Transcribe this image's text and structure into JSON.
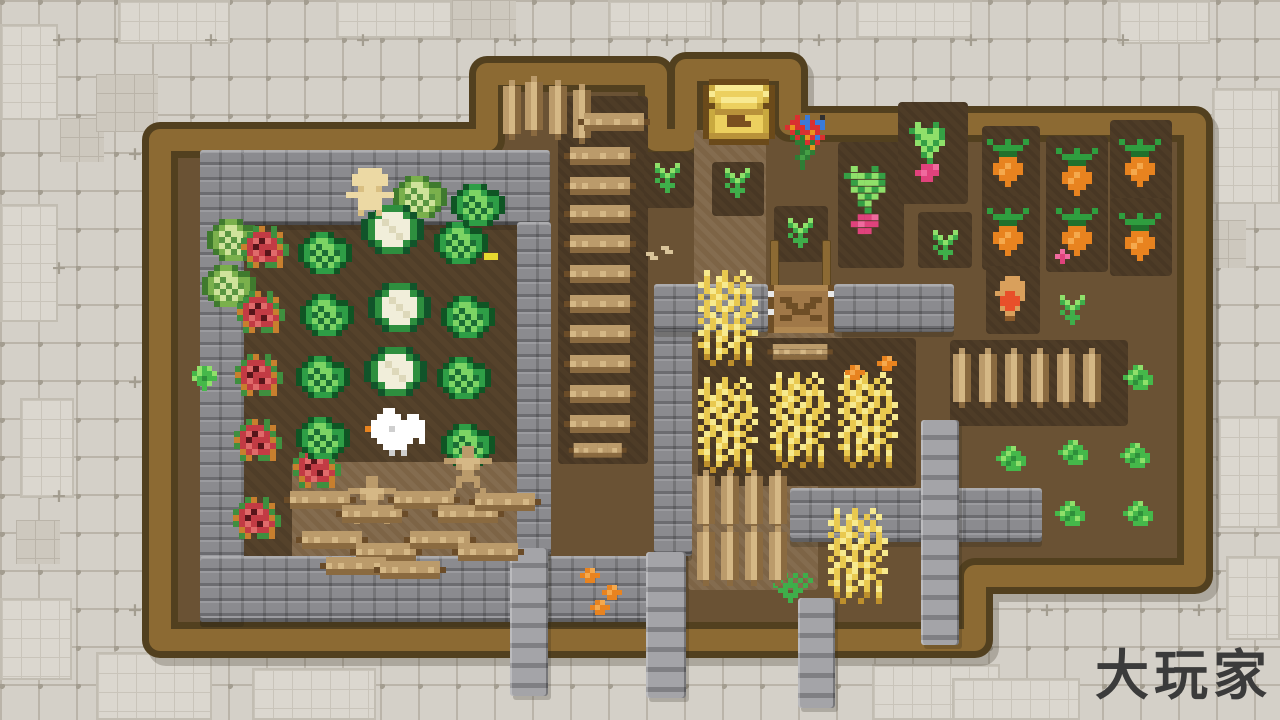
{
  "meta": {
    "watermark": "大玩家"
  },
  "palette": {
    "bgTile": "#d4d0c8",
    "bgLine": "#bab4a9",
    "bgMark": "#a39d90",
    "wood": "#8c6a33",
    "woodDark": "#52401f",
    "dirt": "#6a5234",
    "dirtDark": "#55422b",
    "dirtTill": "#4e3c27",
    "dirtLight": "#7d6446",
    "stone": "#8b8b8f",
    "ink": "#3b3b3b",
    "cabD": "#0f5524",
    "cabG": "#2e9e46",
    "cabL": "#7cd464",
    "cabM": "#1b6e35",
    "lcD": "#3f7a2e",
    "lcG": "#7ab04c",
    "lcL": "#cfe39b",
    "lcM": "#5a9641",
    "cfW": "#f1eeda",
    "cfw": "#ddd8ba",
    "cfG": "#2e8f3f",
    "cfD": "#11542a",
    "roseR": "#c23b44",
    "roseHi": "#e06a6a",
    "roseD": "#58151a",
    "roseG": "#3f8f3f",
    "roseO": "#c87f2e",
    "carO": "#e8831f",
    "carHi": "#f5a94d",
    "carG": "#2f9e3f",
    "carGD": "#20702c",
    "radP": "#e0427c",
    "radHi": "#f06a9e",
    "radG": "#35a045",
    "sprG": "#3fae4a",
    "sprL": "#8fe06a",
    "bushB": "#45b84a",
    "bushL": "#8fe06a",
    "bushD": "#2e8f3a",
    "whY": "#e9c94f",
    "whL": "#f7ea8e",
    "whD": "#bd8f2c",
    "chK": "#6b4a1a",
    "chG": "#c9a93f",
    "chY": "#ecd05f",
    "chHi": "#f8ea92",
    "chB": "#b8923a",
    "chSlot": "#7a4f1f",
    "plT": "#ecd9a4",
    "plS": "#d9bf82",
    "wW": "#ffffff",
    "wS": "#cfcfcf",
    "gnT": "#d9a05c",
    "gnR": "#e8502a",
    "gnD": "#8a5a2a",
    "flR": "#d93030",
    "flB": "#3a7bd9",
    "flO": "#e8931f",
    "flY": "#e8d92f",
    "flG": "#2e7d35",
    "flg": "#45a045",
    "flK": "#303030",
    "gateP": "#a07848",
    "gatep": "#b08852",
    "gateD": "#6e4e26",
    "gateW": "#e8e8e8",
    "logMid": "#bb9b6b",
    "logHi": "#d5b886",
    "logLo": "#8a6a40",
    "logEnd": "#6b4c28",
    "seed": "#d9c49a"
  },
  "farm": {
    "outline": [
      [
        160,
        140
      ],
      [
        487,
        140
      ],
      [
        487,
        74
      ],
      [
        656,
        74
      ],
      [
        656,
        140
      ],
      [
        686,
        140
      ],
      [
        686,
        70
      ],
      [
        790,
        70
      ],
      [
        790,
        124
      ],
      [
        1195,
        124
      ],
      [
        1195,
        576
      ],
      [
        975,
        576
      ],
      [
        975,
        640
      ],
      [
        160,
        640
      ]
    ]
  },
  "bg_patches": [
    {
      "kind": "tile-light",
      "x": 118,
      "y": 0,
      "w": 112,
      "h": 44
    },
    {
      "kind": "tile-light",
      "x": 336,
      "y": 0,
      "w": 116,
      "h": 38
    },
    {
      "kind": "tile-light",
      "x": 608,
      "y": 0,
      "w": 104,
      "h": 38
    },
    {
      "kind": "tile-light",
      "x": 856,
      "y": 0,
      "w": 116,
      "h": 38
    },
    {
      "kind": "tile-light",
      "x": 1118,
      "y": 0,
      "w": 92,
      "h": 44
    },
    {
      "kind": "tile-light",
      "x": 0,
      "y": 24,
      "w": 58,
      "h": 96
    },
    {
      "kind": "tile-light",
      "x": 1212,
      "y": 88,
      "w": 68,
      "h": 116
    },
    {
      "kind": "tile-light",
      "x": 0,
      "y": 204,
      "w": 58,
      "h": 118
    },
    {
      "kind": "tile-light",
      "x": 20,
      "y": 398,
      "w": 54,
      "h": 100
    },
    {
      "kind": "tile-light",
      "x": 0,
      "y": 598,
      "w": 72,
      "h": 82
    },
    {
      "kind": "tile-light",
      "x": 96,
      "y": 652,
      "w": 116,
      "h": 68
    },
    {
      "kind": "tile-light",
      "x": 252,
      "y": 668,
      "w": 124,
      "h": 52
    },
    {
      "kind": "tile-light",
      "x": 872,
      "y": 664,
      "w": 128,
      "h": 56
    },
    {
      "kind": "tile-light",
      "x": 1218,
      "y": 416,
      "w": 62,
      "h": 112
    },
    {
      "kind": "tile-light",
      "x": 1226,
      "y": 556,
      "w": 54,
      "h": 84
    },
    {
      "kind": "tile-light",
      "x": 952,
      "y": 678,
      "w": 128,
      "h": 42
    },
    {
      "kind": "tile-fine",
      "x": 60,
      "y": 118,
      "w": 44,
      "h": 44
    },
    {
      "kind": "tile-fine",
      "x": 452,
      "y": 0,
      "w": 64,
      "h": 38
    },
    {
      "kind": "tile-fine",
      "x": 16,
      "y": 520,
      "w": 44,
      "h": 44
    },
    {
      "kind": "tile-fine",
      "x": 1190,
      "y": 220,
      "w": 56,
      "h": 48
    },
    {
      "kind": "tile-fine",
      "x": 96,
      "y": 74,
      "w": 62,
      "h": 58
    }
  ],
  "structures": [
    {
      "kind": "dirt-dark",
      "x": 244,
      "y": 194,
      "w": 274,
      "h": 364
    },
    {
      "kind": "dirt-light",
      "x": 292,
      "y": 462,
      "w": 226,
      "h": 104
    },
    {
      "kind": "dirt-light",
      "x": 694,
      "y": 130,
      "w": 72,
      "h": 164
    },
    {
      "kind": "dirt-light",
      "x": 756,
      "y": 330,
      "w": 86,
      "h": 44
    },
    {
      "kind": "dirt-light",
      "x": 688,
      "y": 474,
      "w": 130,
      "h": 116
    },
    {
      "kind": "dirt-till",
      "x": 558,
      "y": 96,
      "w": 90,
      "h": 368
    },
    {
      "kind": "dirt-till",
      "x": 698,
      "y": 338,
      "w": 218,
      "h": 148
    },
    {
      "kind": "dirt-till",
      "x": 838,
      "y": 142,
      "w": 66,
      "h": 126
    },
    {
      "kind": "dirt-till",
      "x": 898,
      "y": 102,
      "w": 70,
      "h": 102
    },
    {
      "kind": "dirt-till",
      "x": 982,
      "y": 126,
      "w": 58,
      "h": 82
    },
    {
      "kind": "dirt-till",
      "x": 1046,
      "y": 136,
      "w": 62,
      "h": 74
    },
    {
      "kind": "dirt-till",
      "x": 1110,
      "y": 120,
      "w": 62,
      "h": 86
    },
    {
      "kind": "dirt-till",
      "x": 982,
      "y": 196,
      "w": 58,
      "h": 74
    },
    {
      "kind": "dirt-till",
      "x": 1046,
      "y": 200,
      "w": 62,
      "h": 72
    },
    {
      "kind": "dirt-till",
      "x": 1110,
      "y": 198,
      "w": 62,
      "h": 78
    },
    {
      "kind": "dirt-till",
      "x": 986,
      "y": 266,
      "w": 54,
      "h": 68
    },
    {
      "kind": "dirt-till",
      "x": 644,
      "y": 152,
      "w": 50,
      "h": 56
    },
    {
      "kind": "dirt-till",
      "x": 712,
      "y": 162,
      "w": 52,
      "h": 54
    },
    {
      "kind": "dirt-till",
      "x": 774,
      "y": 206,
      "w": 54,
      "h": 56
    },
    {
      "kind": "dirt-till",
      "x": 918,
      "y": 212,
      "w": 54,
      "h": 56
    },
    {
      "kind": "dirt-till",
      "x": 950,
      "y": 340,
      "w": 178,
      "h": 86
    },
    {
      "kind": "stone",
      "x": 200,
      "y": 150,
      "w": 350,
      "h": 75
    },
    {
      "kind": "stone",
      "x": 200,
      "y": 150,
      "w": 44,
      "h": 472
    },
    {
      "kind": "stone",
      "x": 200,
      "y": 556,
      "w": 455,
      "h": 66
    },
    {
      "kind": "stone",
      "x": 517,
      "y": 222,
      "w": 34,
      "h": 334
    },
    {
      "kind": "stone",
      "x": 654,
      "y": 284,
      "w": 38,
      "h": 272
    },
    {
      "kind": "stone",
      "x": 654,
      "y": 284,
      "w": 114,
      "h": 48
    },
    {
      "kind": "stone",
      "x": 834,
      "y": 284,
      "w": 120,
      "h": 48
    },
    {
      "kind": "stone",
      "x": 790,
      "y": 488,
      "w": 252,
      "h": 54
    },
    {
      "kind": "pillar",
      "x": 921,
      "y": 420,
      "w": 38,
      "h": 225
    },
    {
      "kind": "pillar",
      "x": 510,
      "y": 548,
      "w": 38,
      "h": 148
    },
    {
      "kind": "pillar",
      "x": 646,
      "y": 552,
      "w": 40,
      "h": 146
    },
    {
      "kind": "pillar",
      "x": 798,
      "y": 598,
      "w": 37,
      "h": 110
    },
    {
      "kind": "wood",
      "x": 770,
      "y": 240,
      "w": 9,
      "h": 48
    },
    {
      "kind": "wood",
      "x": 822,
      "y": 240,
      "w": 9,
      "h": 48
    }
  ],
  "sprites": [
    {
      "t": "light_cabbage",
      "x": 234,
      "y": 240
    },
    {
      "t": "light_cabbage",
      "x": 229,
      "y": 286
    },
    {
      "t": "light_cabbage",
      "x": 420,
      "y": 197
    },
    {
      "t": "rose",
      "x": 268,
      "y": 247
    },
    {
      "t": "rose",
      "x": 264,
      "y": 312
    },
    {
      "t": "rose",
      "x": 262,
      "y": 375
    },
    {
      "t": "rose",
      "x": 261,
      "y": 440
    },
    {
      "t": "rose",
      "x": 320,
      "y": 467
    },
    {
      "t": "rose",
      "x": 260,
      "y": 518
    },
    {
      "t": "cabbage",
      "x": 325,
      "y": 253
    },
    {
      "t": "cabbage",
      "x": 327,
      "y": 315
    },
    {
      "t": "cabbage",
      "x": 323,
      "y": 377
    },
    {
      "t": "cabbage",
      "x": 323,
      "y": 438
    },
    {
      "t": "cabbage",
      "x": 461,
      "y": 243
    },
    {
      "t": "cabbage",
      "x": 468,
      "y": 317
    },
    {
      "t": "cabbage",
      "x": 464,
      "y": 378
    },
    {
      "t": "cabbage",
      "x": 468,
      "y": 445
    },
    {
      "t": "cabbage",
      "x": 478,
      "y": 205
    },
    {
      "t": "cauliflower",
      "x": 392,
      "y": 229
    },
    {
      "t": "cauliflower",
      "x": 399,
      "y": 307
    },
    {
      "t": "cauliflower",
      "x": 395,
      "y": 371
    },
    {
      "t": "player",
      "x": 370,
      "y": 192
    },
    {
      "t": "chicken",
      "x": 398,
      "y": 432
    },
    {
      "t": "stump",
      "x": 372,
      "y": 500
    },
    {
      "t": "stump",
      "x": 468,
      "y": 470
    },
    {
      "t": "item_yellow",
      "x": 491,
      "y": 256
    },
    {
      "t": "moss",
      "x": 207,
      "y": 378
    },
    {
      "t": "hlog",
      "x": 320,
      "y": 500
    },
    {
      "t": "hlog",
      "x": 372,
      "y": 514
    },
    {
      "t": "hlog",
      "x": 424,
      "y": 500
    },
    {
      "t": "hlog",
      "x": 468,
      "y": 514
    },
    {
      "t": "hlog",
      "x": 505,
      "y": 502
    },
    {
      "t": "hlog",
      "x": 332,
      "y": 540
    },
    {
      "t": "hlog",
      "x": 386,
      "y": 552
    },
    {
      "t": "hlog",
      "x": 440,
      "y": 540
    },
    {
      "t": "hlog",
      "x": 488,
      "y": 552
    },
    {
      "t": "hlog",
      "x": 356,
      "y": 566
    },
    {
      "t": "hlog",
      "x": 410,
      "y": 570
    },
    {
      "t": "vlog",
      "x": 512,
      "y": 110
    },
    {
      "t": "vlog",
      "x": 534,
      "y": 106
    },
    {
      "t": "vlog",
      "x": 558,
      "y": 110
    },
    {
      "t": "vlog",
      "x": 582,
      "y": 114
    },
    {
      "t": "hlog",
      "x": 614,
      "y": 122
    },
    {
      "t": "hlog",
      "x": 600,
      "y": 156
    },
    {
      "t": "hlog",
      "x": 600,
      "y": 186
    },
    {
      "t": "hlog",
      "x": 600,
      "y": 214
    },
    {
      "t": "hlog",
      "x": 600,
      "y": 244
    },
    {
      "t": "hlog",
      "x": 600,
      "y": 274
    },
    {
      "t": "hlog",
      "x": 600,
      "y": 304
    },
    {
      "t": "hlog",
      "x": 600,
      "y": 334
    },
    {
      "t": "hlog",
      "x": 600,
      "y": 364
    },
    {
      "t": "hlog",
      "x": 600,
      "y": 394
    },
    {
      "t": "hlog",
      "x": 600,
      "y": 424
    },
    {
      "t": "hlog",
      "x": 598,
      "y": 450,
      "sc": 0.8
    },
    {
      "t": "chest",
      "x": 739,
      "y": 112
    },
    {
      "t": "flowers",
      "x": 810,
      "y": 142
    },
    {
      "t": "sprout",
      "x": 667,
      "y": 178
    },
    {
      "t": "sprout",
      "x": 737,
      "y": 183
    },
    {
      "t": "sprout",
      "x": 800,
      "y": 233
    },
    {
      "t": "sprout",
      "x": 945,
      "y": 245
    },
    {
      "t": "sprout",
      "x": 1072,
      "y": 310
    },
    {
      "t": "radish",
      "x": 930,
      "y": 152
    },
    {
      "t": "radish",
      "x": 868,
      "y": 200,
      "sc": 1.15
    },
    {
      "t": "item_radish",
      "x": 1062,
      "y": 256
    },
    {
      "t": "carrot",
      "x": 1008,
      "y": 163
    },
    {
      "t": "carrot",
      "x": 1077,
      "y": 172
    },
    {
      "t": "carrot",
      "x": 1140,
      "y": 163
    },
    {
      "t": "carrot",
      "x": 1008,
      "y": 232
    },
    {
      "t": "carrot",
      "x": 1077,
      "y": 232
    },
    {
      "t": "carrot",
      "x": 1140,
      "y": 237
    },
    {
      "t": "gnome",
      "x": 1012,
      "y": 298
    },
    {
      "t": "wheat",
      "x": 728,
      "y": 318
    },
    {
      "t": "wheat",
      "x": 728,
      "y": 425
    },
    {
      "t": "wheat",
      "x": 800,
      "y": 420
    },
    {
      "t": "wheat",
      "x": 868,
      "y": 420
    },
    {
      "t": "wheat",
      "x": 858,
      "y": 556
    },
    {
      "t": "item_orange",
      "x": 855,
      "y": 372
    },
    {
      "t": "item_orange",
      "x": 887,
      "y": 363
    },
    {
      "t": "item_orange",
      "x": 590,
      "y": 575
    },
    {
      "t": "item_orange",
      "x": 612,
      "y": 592
    },
    {
      "t": "item_orange",
      "x": 600,
      "y": 607
    },
    {
      "t": "item_seed",
      "x": 652,
      "y": 256
    },
    {
      "t": "item_seed",
      "x": 667,
      "y": 250
    },
    {
      "t": "grass",
      "x": 795,
      "y": 588
    },
    {
      "t": "bush",
      "x": 1013,
      "y": 458
    },
    {
      "t": "bush",
      "x": 1075,
      "y": 452
    },
    {
      "t": "bush",
      "x": 1140,
      "y": 377
    },
    {
      "t": "bush",
      "x": 1137,
      "y": 455
    },
    {
      "t": "bush",
      "x": 1072,
      "y": 513
    },
    {
      "t": "bush",
      "x": 1140,
      "y": 513
    },
    {
      "t": "vlog",
      "x": 962,
      "y": 378
    },
    {
      "t": "vlog",
      "x": 988,
      "y": 378
    },
    {
      "t": "vlog",
      "x": 1014,
      "y": 378
    },
    {
      "t": "vlog",
      "x": 1040,
      "y": 378
    },
    {
      "t": "vlog",
      "x": 1066,
      "y": 378
    },
    {
      "t": "vlog",
      "x": 1092,
      "y": 378
    },
    {
      "t": "vlog",
      "x": 706,
      "y": 500
    },
    {
      "t": "vlog",
      "x": 730,
      "y": 500
    },
    {
      "t": "vlog",
      "x": 754,
      "y": 500
    },
    {
      "t": "vlog",
      "x": 778,
      "y": 500
    },
    {
      "t": "vlog",
      "x": 706,
      "y": 556
    },
    {
      "t": "vlog",
      "x": 730,
      "y": 556
    },
    {
      "t": "vlog",
      "x": 754,
      "y": 556
    },
    {
      "t": "vlog",
      "x": 778,
      "y": 556
    },
    {
      "t": "gate",
      "x": 801,
      "y": 309
    },
    {
      "t": "hlog",
      "x": 800,
      "y": 352,
      "sc": 0.9
    }
  ]
}
